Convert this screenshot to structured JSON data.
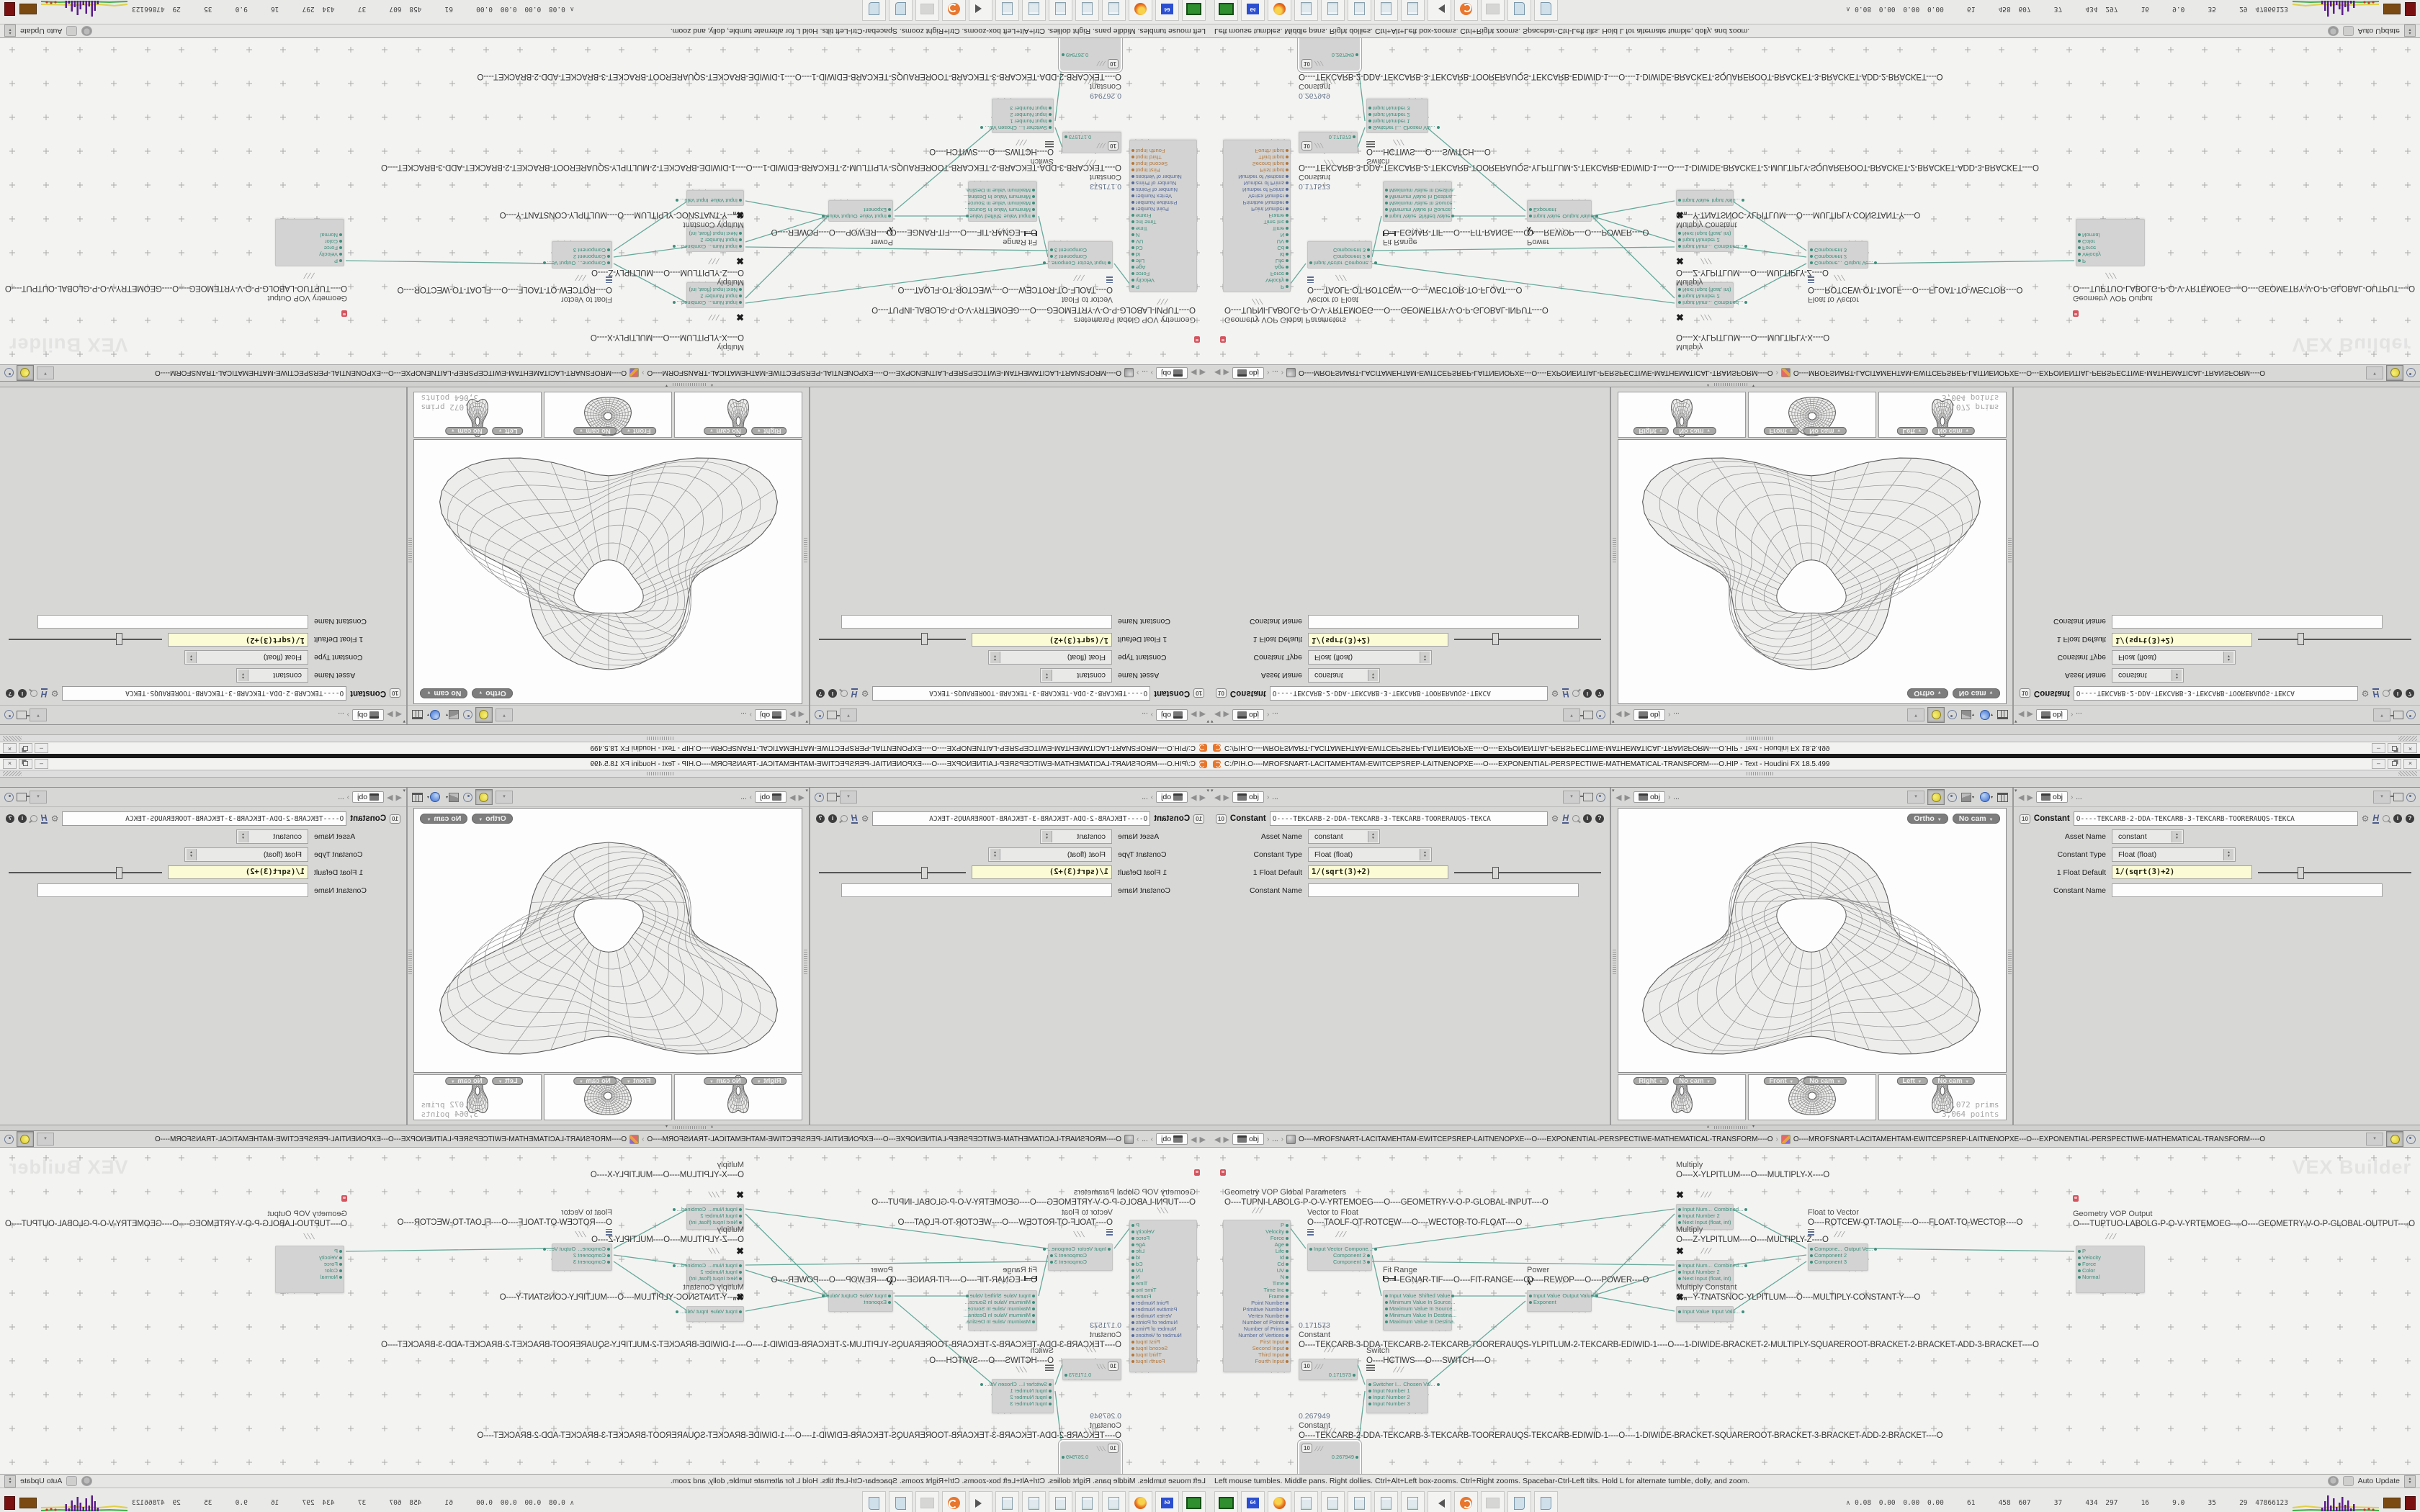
{
  "window": {
    "title": "C:/PIH.O----MROFSNART-LACITAMEHTAM-EWITCEPSREP-LAITNENOPXE----O----EXPONENTIAL-PERSPECTIWE-MATHEMATICAL-TRANSFORM----O.HIP - Text - Houdini FX 18.5.499"
  },
  "nav": {
    "context": "obj",
    "ellipsis": "..."
  },
  "params": {
    "node_type": "Constant",
    "node_name": "O----TEKCARB-2-DDA-TEKCARB-3-TEKCARB-TOORERAUQS-TEKCA",
    "asset_name_label": "Asset Name",
    "asset_name_value": "constant",
    "constant_type_label": "Constant Type",
    "constant_type_value": "Float (float)",
    "float_default_label": "1 Float Default",
    "float_default_value": "1/(sqrt(3)+2)",
    "constant_name_label": "Constant Name",
    "constant_name_value": ""
  },
  "viewport": {
    "ortho": "Ortho",
    "no_cam": "No cam",
    "views": [
      {
        "label": "Right"
      },
      {
        "label": "Front"
      },
      {
        "label": "Left"
      }
    ],
    "stats_prims": "3,072  prims",
    "stats_points": "3,064 points"
  },
  "network": {
    "watermark": "VEX Builder",
    "path_context": "obj",
    "path_ellipsis": "...",
    "path1": "O----MROFSNART-LACITAMEHTAM-EWITCEPSREP-LAITNENOPXE---O----EXPONENTIAL-PERSPECTIWE-MATHEMATICAL-TRANSFORM----O",
    "path2": "O----MROFSNART-LACITAMEHTAM-EWITCEPSREP-LAITNENOPXE---O---EXPONENTIAL-PERSPECTIWE-MATHEMATICAL-TRANSFORM----O",
    "nodes": [
      {
        "id": "geometry-vop-global-parameters",
        "kind": "big",
        "title": "Geometry VOP Global Parameters",
        "label": "O----TUPNI-LABOLG-P-O-V-YRTEMOEG----O----GEOMETRY-V-O-P-GLOBAL-INPUT----O",
        "cap": [
          20,
          56
        ],
        "box": [
          18,
          100,
          92,
          206
        ],
        "flag": true,
        "outputs": [
          {
            "t": "P",
            "c": "t"
          },
          {
            "t": "Velocity",
            "c": "t"
          },
          {
            "t": "Force",
            "c": "t"
          },
          {
            "t": "Age",
            "c": "t"
          },
          {
            "t": "Life",
            "c": "t"
          },
          {
            "t": "Id",
            "c": "t"
          },
          {
            "t": "Cd",
            "c": "t"
          },
          {
            "t": "UV",
            "c": "t"
          },
          {
            "t": "N",
            "c": "t"
          },
          {
            "t": "Time",
            "c": "t"
          },
          {
            "t": "Time Inc",
            "c": "t"
          },
          {
            "t": "Frame",
            "c": "t"
          },
          {
            "t": "Point Number",
            "c": "b"
          },
          {
            "t": "Primitive Number",
            "c": "b"
          },
          {
            "t": "Vertex Number",
            "c": "b"
          },
          {
            "t": "Number of Points",
            "c": "b"
          },
          {
            "t": "Number of Prims",
            "c": "b"
          },
          {
            "t": "Number of Vertices",
            "c": "b"
          },
          {
            "t": "First Input",
            "c": "o"
          },
          {
            "t": "Second Input",
            "c": "o"
          },
          {
            "t": "Third Input",
            "c": "o"
          },
          {
            "t": "Fourth Input",
            "c": "o"
          }
        ]
      },
      {
        "id": "vector-to-float",
        "kind": "std",
        "title": "Vector to Float",
        "label": "O----TAOLF-OT-ROTCEW----O----WECTOR-TO-FLOAT----O",
        "cap": [
          135,
          84
        ],
        "box": [
          135,
          133,
          88,
          32
        ],
        "icon": "vec",
        "rows": [
          {
            "l": "Input Vector",
            "r": "Compone..."
          },
          {
            "r": "Component 2"
          },
          {
            "r": "Component 3"
          }
        ]
      },
      {
        "id": "fit-range",
        "kind": "std",
        "title": "Fit Range",
        "label": "O----EGNAR-TIF----O----FIT-RANGE----O",
        "cap": [
          240,
          164
        ],
        "box": [
          240,
          198,
          94,
          50
        ],
        "icon": "fit",
        "rows": [
          {
            "l": "Input Value",
            "r": "Shifted Value"
          },
          {
            "l": "Minimum Value In Source..."
          },
          {
            "l": "Maximum Value In Source..."
          },
          {
            "l": "Minimum Value In Destina..."
          },
          {
            "l": "Maximum Value In Destina."
          }
        ]
      },
      {
        "id": "power",
        "kind": "std",
        "title": "Power",
        "label": "O----REWOP----O----POWER----O",
        "cap": [
          440,
          164
        ],
        "box": [
          440,
          198,
          88,
          24
        ],
        "icon": "pow",
        "rows": [
          {
            "l": "Input Value",
            "r": "Output Value"
          },
          {
            "l": "Exponent"
          }
        ]
      },
      {
        "id": "multiply-x",
        "kind": "std",
        "title": "Multiply",
        "label": "O----X-YLPITLUM----O----MULTIPLY-X----O",
        "cap": [
          647,
          18
        ],
        "box": [
          647,
          78,
          78,
          30
        ],
        "icon": "mult",
        "rows": [
          {
            "l": "Input Num...",
            "r": "Combined..."
          },
          {
            "l": "Input Number 2"
          },
          {
            "l": "Next Input (float, int)"
          }
        ]
      },
      {
        "id": "multiply-z",
        "kind": "std",
        "title": "Multiply",
        "label": "O----Z-YLPITLUM----O----MULTIPLY-Z----O",
        "cap": [
          647,
          108
        ],
        "box": [
          647,
          156,
          78,
          30
        ],
        "icon": "mult",
        "rows": [
          {
            "l": "Input Num...",
            "r": "Combined..."
          },
          {
            "l": "Input Number 2"
          },
          {
            "l": "Next Input (float, int)"
          }
        ]
      },
      {
        "id": "multiply-constant",
        "kind": "std",
        "title": "Multiply Constant",
        "label": "O----Y-TNATSNOC-YLPITLUM----O----MULTIPLY-CONSTANT-Y----O",
        "cap": [
          647,
          188
        ],
        "box": [
          647,
          220,
          78,
          16
        ],
        "icon": "multn",
        "rows": [
          {
            "l": "Input Value",
            "r": "Input Valu..."
          }
        ]
      },
      {
        "id": "float-to-vector",
        "kind": "std",
        "title": "Float to Vector",
        "label": "O----ROTCEW-OT-TAOLF----O----FLOAT-TO-WECTOR----O",
        "cap": [
          830,
          84
        ],
        "box": [
          830,
          133,
          82,
          32
        ],
        "icon": "vec",
        "rows": [
          {
            "l": "Compone...",
            "r": "Output Ve..."
          },
          {
            "l": "Component 2"
          },
          {
            "l": "Component 3"
          }
        ]
      },
      {
        "id": "geometry-vop-output",
        "kind": "std",
        "title": "Geometry VOP Output",
        "label": "O----TUPTUO-LABOLG-P-O-V-YRTEMOEG----O----GEOMETRY-V-O-P-GLOBAL-OUTPUT----O",
        "cap": [
          1198,
          86
        ],
        "box": [
          1202,
          136,
          94,
          60
        ],
        "flag": true,
        "rows": [
          {
            "l": "P"
          },
          {
            "l": "Velocity"
          },
          {
            "l": "Force"
          },
          {
            "l": "Color"
          },
          {
            "l": "Normal"
          }
        ]
      },
      {
        "id": "constant-1",
        "kind": "const",
        "title": "Constant",
        "value": "0.171573",
        "label": "O----TEKCARB-3-DDA-TEKCARB-2-TEKCARB-TOORERAUQS-YLPITLUM-2-TEKCARB-EDIWID-1----O----1-DIWIDE-BRACKET-2-MULTIPLY-SQUAREROOT-BRACKET-2-BRACKET-ADD-3-BRACKET----O",
        "cap": [
          123,
          241
        ],
        "box": [
          123,
          293,
          80,
          22
        ]
      },
      {
        "id": "switch",
        "kind": "std",
        "title": "Switch",
        "label": "O----HCTIWS----O----SWITCH----O",
        "cap": [
          217,
          276
        ],
        "box": [
          217,
          321,
          84,
          42
        ],
        "icon": "swi",
        "rows": [
          {
            "l": "Switcher I...",
            "r": "Chosen Val..."
          },
          {
            "l": "Input Number 1"
          },
          {
            "l": "Input Number 2"
          },
          {
            "l": "Input Number 3"
          }
        ]
      },
      {
        "id": "constant-2",
        "kind": "const",
        "title": "Constant",
        "value": "0.267949",
        "selected": true,
        "label": "O----TEKCARB-2-DDA-TEKCARB-3-TEKCARB-TOORERAUQS-TEKCARB-EDIWID-1----O----1-DIWIDE-BRACKET-SQUAREROOT-BRACKET-3-BRACKET-ADD-2-BRACKET----O",
        "cap": [
          123,
          367
        ],
        "box": [
          122,
          406,
          84,
          46
        ]
      }
    ]
  },
  "statusbar": {
    "help": "Left mouse tumbles. Middle pans. Right dollies. Ctrl+Alt+Left box-zooms. Ctrl+Right zooms. Spacebar-Ctrl-Left tilts. Hold L for alternate tumble, dolly, and zoom.",
    "auto_update": "Auto Update"
  },
  "taskbar": {
    "icons": [
      "display",
      "save",
      "firefox",
      "notepad",
      "notepad",
      "notepad",
      "notepad",
      "notepad",
      "volume",
      "houdini",
      "render",
      "script",
      "script"
    ],
    "stats": "0.08 0.00 0.00 0.00   61   458 607   37   434 297   16   9.0   35   29 47866123"
  }
}
